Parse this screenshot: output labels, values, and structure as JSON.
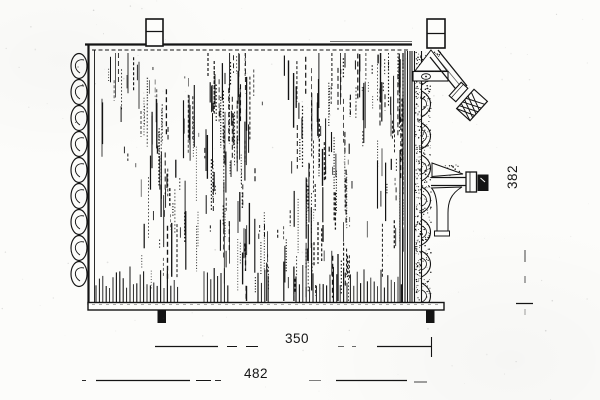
{
  "colors": {
    "ink": "#141414",
    "paper": "#fcfcfa"
  },
  "drawing": {
    "dimensions": {
      "height": {
        "value": "382",
        "orientation": "vertical"
      },
      "core_width": {
        "value": "350",
        "orientation": "horizontal"
      },
      "overall_width": {
        "value": "482",
        "orientation": "horizontal"
      }
    }
  }
}
